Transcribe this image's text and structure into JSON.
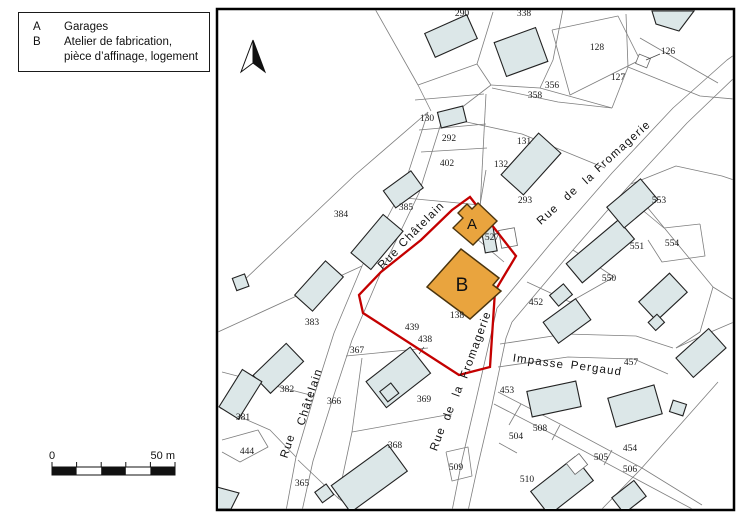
{
  "legend": {
    "items": [
      {
        "key": "A",
        "lines": [
          "Garages"
        ]
      },
      {
        "key": "B",
        "lines": [
          "Atelier de fabrication,",
          "pièce d’affinage, logement"
        ]
      }
    ]
  },
  "scale_bar": {
    "start": "0",
    "end": "50 m"
  },
  "map": {
    "colors": {
      "highlight_fill": "#e9a43e",
      "boundary_red": "#c40000",
      "building_fill": "#dce7e8",
      "parcel_line": "#7e7e7e"
    },
    "unit_labels": [
      {
        "text": "A",
        "x": 472,
        "y": 229,
        "size": 15
      },
      {
        "text": "B",
        "x": 462,
        "y": 291,
        "size": 19
      }
    ],
    "street_labels": [
      {
        "text": "Rue",
        "x": 391,
        "y": 261,
        "angle": -45
      },
      {
        "text": "Châtelain",
        "x": 424,
        "y": 227,
        "angle": -45
      },
      {
        "text": "Rue",
        "x": 291,
        "y": 447,
        "angle": -72
      },
      {
        "text": "Châtelain",
        "x": 313,
        "y": 398,
        "angle": -72
      },
      {
        "text": "Rue",
        "x": 550,
        "y": 217,
        "angle": -42
      },
      {
        "text": "de",
        "x": 573,
        "y": 196,
        "angle": -42
      },
      {
        "text": "la",
        "x": 591,
        "y": 181,
        "angle": -42
      },
      {
        "text": "Fromagerie",
        "x": 625,
        "y": 149,
        "angle": -42
      },
      {
        "text": "Rue",
        "x": 441,
        "y": 440,
        "angle": -70
      },
      {
        "text": "de",
        "x": 452,
        "y": 414,
        "angle": -70
      },
      {
        "text": "la",
        "x": 461,
        "y": 392,
        "angle": -70
      },
      {
        "text": "Fromagerie",
        "x": 479,
        "y": 346,
        "angle": -70
      },
      {
        "text": "Impasse",
        "x": 538,
        "y": 365,
        "angle": 8
      },
      {
        "text": "Pergaud",
        "x": 596,
        "y": 372,
        "angle": 8
      }
    ],
    "parcel_labels": [
      {
        "text": "290",
        "x": 462,
        "y": 16
      },
      {
        "text": "338",
        "x": 524,
        "y": 16
      },
      {
        "text": "128",
        "x": 597,
        "y": 50
      },
      {
        "text": "126",
        "x": 668,
        "y": 54
      },
      {
        "text": "127",
        "x": 618,
        "y": 80
      },
      {
        "text": "356",
        "x": 552,
        "y": 88
      },
      {
        "text": "358",
        "x": 535,
        "y": 98
      },
      {
        "text": "130",
        "x": 427,
        "y": 121
      },
      {
        "text": "292",
        "x": 449,
        "y": 141
      },
      {
        "text": "402",
        "x": 447,
        "y": 166
      },
      {
        "text": "131",
        "x": 524,
        "y": 144
      },
      {
        "text": "132",
        "x": 501,
        "y": 167
      },
      {
        "text": "293",
        "x": 525,
        "y": 203
      },
      {
        "text": "385",
        "x": 406,
        "y": 210
      },
      {
        "text": "384",
        "x": 341,
        "y": 217
      },
      {
        "text": "527",
        "x": 492,
        "y": 240
      },
      {
        "text": "553",
        "x": 659,
        "y": 203
      },
      {
        "text": "551",
        "x": 637,
        "y": 249
      },
      {
        "text": "554",
        "x": 672,
        "y": 246
      },
      {
        "text": "550",
        "x": 609,
        "y": 281
      },
      {
        "text": "452",
        "x": 536,
        "y": 305
      },
      {
        "text": "383",
        "x": 312,
        "y": 325
      },
      {
        "text": "138",
        "x": 457,
        "y": 318
      },
      {
        "text": "439",
        "x": 412,
        "y": 330
      },
      {
        "text": "438",
        "x": 425,
        "y": 342
      },
      {
        "text": "367",
        "x": 357,
        "y": 353
      },
      {
        "text": "366",
        "x": 334,
        "y": 404
      },
      {
        "text": "369",
        "x": 424,
        "y": 402
      },
      {
        "text": "453",
        "x": 507,
        "y": 393
      },
      {
        "text": "382",
        "x": 287,
        "y": 392
      },
      {
        "text": "381",
        "x": 243,
        "y": 420
      },
      {
        "text": "457",
        "x": 631,
        "y": 365
      },
      {
        "text": "444",
        "x": 247,
        "y": 454
      },
      {
        "text": "508",
        "x": 540,
        "y": 431
      },
      {
        "text": "504",
        "x": 516,
        "y": 439
      },
      {
        "text": "454",
        "x": 630,
        "y": 451
      },
      {
        "text": "365",
        "x": 302,
        "y": 486
      },
      {
        "text": "368",
        "x": 395,
        "y": 448
      },
      {
        "text": "505",
        "x": 601,
        "y": 460
      },
      {
        "text": "506",
        "x": 630,
        "y": 472
      },
      {
        "text": "510",
        "x": 527,
        "y": 482
      },
      {
        "text": "509",
        "x": 456,
        "y": 470
      }
    ]
  }
}
